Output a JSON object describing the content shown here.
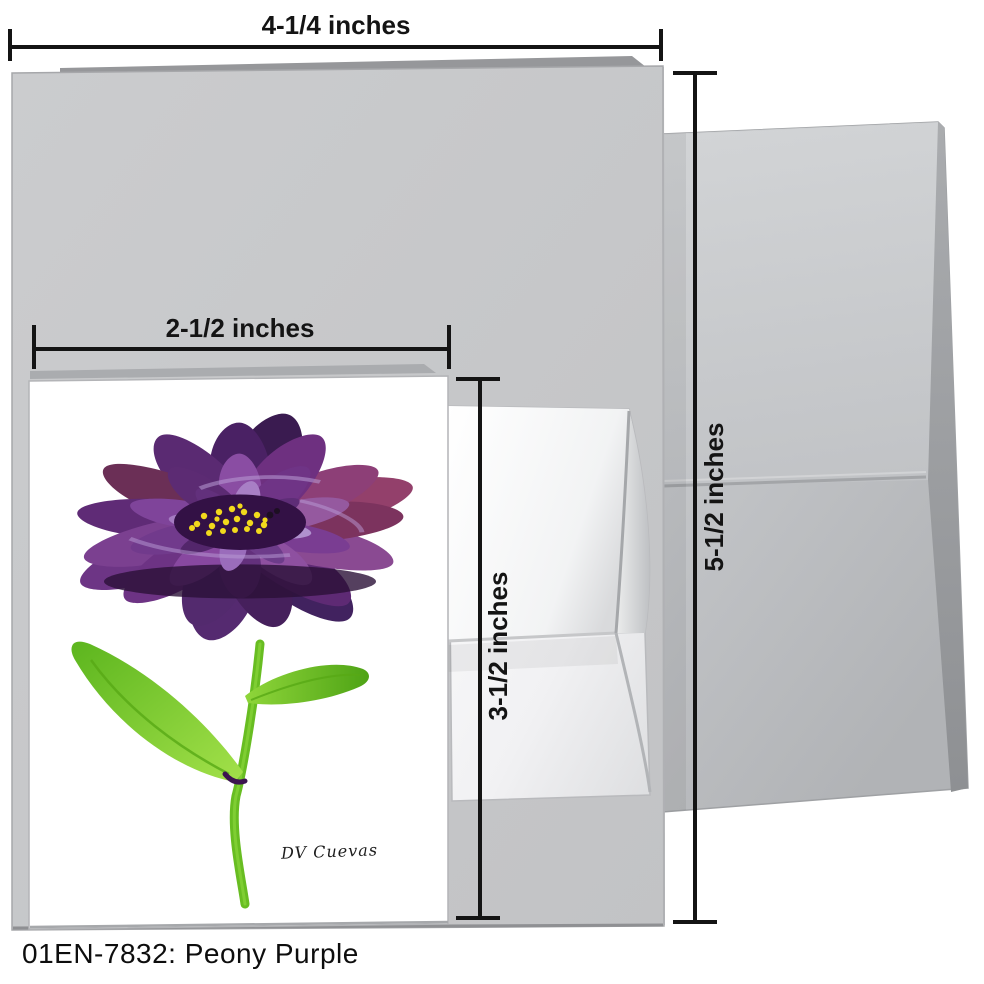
{
  "caption": {
    "text": "01EN-7832: Peony Purple"
  },
  "dimensions": {
    "large_card_width": "4-1/4 inches",
    "large_card_height": "5-1/2 inches",
    "small_card_width": "2-1/2 inches",
    "small_card_height": "3-1/2 inches"
  },
  "artwork": {
    "signature": "DV Cuevas",
    "subject": "purple peony painting"
  },
  "colors": {
    "dimension_line": "#141414",
    "large_card_gray": "#c7c8ca",
    "envelope_gray": "#c0c2c5",
    "small_envelope_white": "#f7f7f8",
    "petal_purple": "#5b2a70",
    "petal_magenta": "#8d3f77",
    "leaf_green": "#68bd22",
    "stamen_yellow": "#f2da1c"
  }
}
